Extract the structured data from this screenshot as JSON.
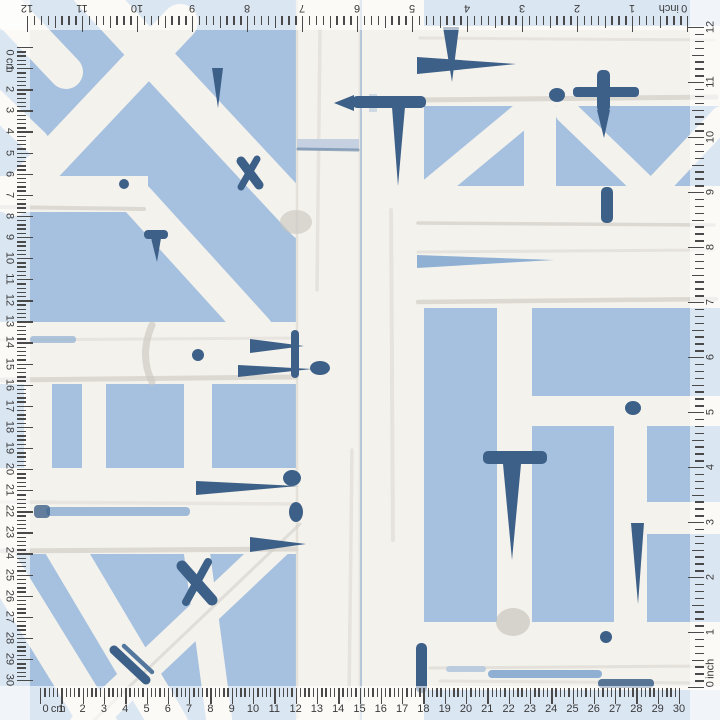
{
  "pattern": {
    "description": "Blue and white watercolor bamboo trellis wallpaper swatch",
    "colors": {
      "background_blue": "#a6c1e0",
      "bamboo_white": "#f4f2ec",
      "bamboo_shadow": "#d7d4ce",
      "bamboo_shadow_dark": "#c6c3bd",
      "accent_navy": "#3d6088",
      "accent_navy_mid": "#54779d",
      "accent_blue_light": "#8fb0d3",
      "accent_blue_pale": "#bcccdf"
    }
  },
  "rulers": {
    "tick_color": "#4a4a4a",
    "number_color": "#3a3a3a",
    "strip_color": "rgba(255,255,255,0.60)",
    "top": {
      "unit_label": "inch",
      "labels": [
        "0",
        "1",
        "2",
        "3",
        "4",
        "5",
        "6",
        "7",
        "8",
        "9",
        "10",
        "11",
        "12"
      ],
      "zero_px": 687,
      "px_per_unit": 55,
      "subdivisions": 8,
      "direction": -1
    },
    "right": {
      "unit_label": "inch",
      "labels": [
        "0",
        "1",
        "2",
        "3",
        "4",
        "5",
        "6",
        "7",
        "8",
        "9",
        "10",
        "11",
        "12"
      ],
      "zero_px": 687,
      "px_per_unit": 55,
      "subdivisions": 8,
      "direction": -1
    },
    "bottom": {
      "unit_label": "cm",
      "labels": [
        "0",
        "1",
        "2",
        "3",
        "4",
        "5",
        "6",
        "7",
        "8",
        "9",
        "10",
        "11",
        "12",
        "13",
        "14",
        "15",
        "16",
        "17",
        "18",
        "19",
        "20",
        "21",
        "22",
        "23",
        "24",
        "25",
        "26",
        "27",
        "28",
        "29",
        "30"
      ],
      "zero_px": 40,
      "px_per_unit": 21.3,
      "subdivisions": 5,
      "direction": 1
    },
    "left": {
      "unit_label": "cm",
      "labels": [
        "0",
        "1",
        "2",
        "3",
        "4",
        "5",
        "6",
        "7",
        "8",
        "9",
        "10",
        "11",
        "12",
        "13",
        "14",
        "15",
        "16",
        "17",
        "18",
        "19",
        "20",
        "21",
        "22",
        "23",
        "24",
        "25",
        "26",
        "27",
        "28",
        "29",
        "30"
      ],
      "zero_px": 47,
      "px_per_unit": 21.1,
      "subdivisions": 5,
      "direction": 1
    }
  }
}
